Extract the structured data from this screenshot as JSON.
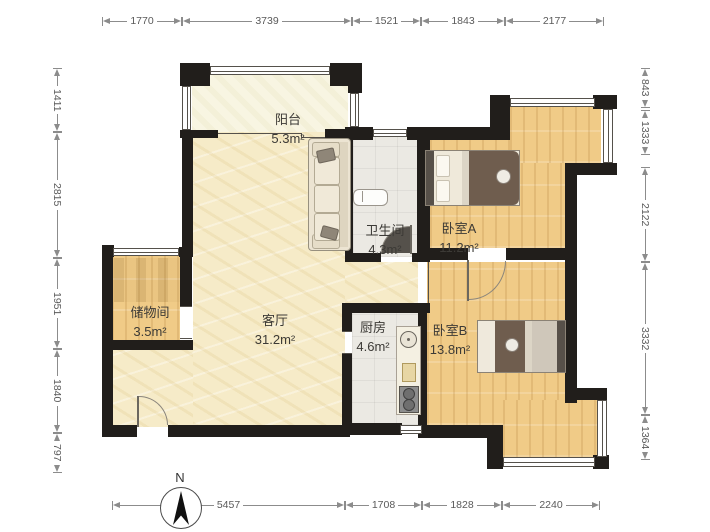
{
  "rooms": {
    "balcony": {
      "name": "阳台",
      "area": "5.3m²"
    },
    "bathroom": {
      "name": "卫生间",
      "area": "4.3m²"
    },
    "bedroom_a": {
      "name": "卧室A",
      "area": "11.2m²"
    },
    "bedroom_b": {
      "name": "卧室B",
      "area": "13.8m²"
    },
    "storage": {
      "name": "储物间",
      "area": "3.5m²"
    },
    "living": {
      "name": "客厅",
      "area": "31.2m²"
    },
    "kitchen": {
      "name": "厨房",
      "area": "4.6m²"
    }
  },
  "dimensions": {
    "top": [
      "1770",
      "3739",
      "1521",
      "1843",
      "2177"
    ],
    "bottom": [
      "5457",
      "1708",
      "1828",
      "2240"
    ],
    "left": [
      "1411",
      "2815",
      "1951",
      "1840",
      "797"
    ],
    "right": [
      "843",
      "1333",
      "2122",
      "3332",
      "1364"
    ]
  },
  "compass": {
    "label": "N"
  },
  "colors": {
    "wall": "#211e1b",
    "wood_floor": "#f0cb87",
    "parchment_floor": "#f6ebc8",
    "tile_floor": "#ebe9e3",
    "balcony_floor": "#f8f5e2",
    "dimension": "#8c8c8c"
  }
}
